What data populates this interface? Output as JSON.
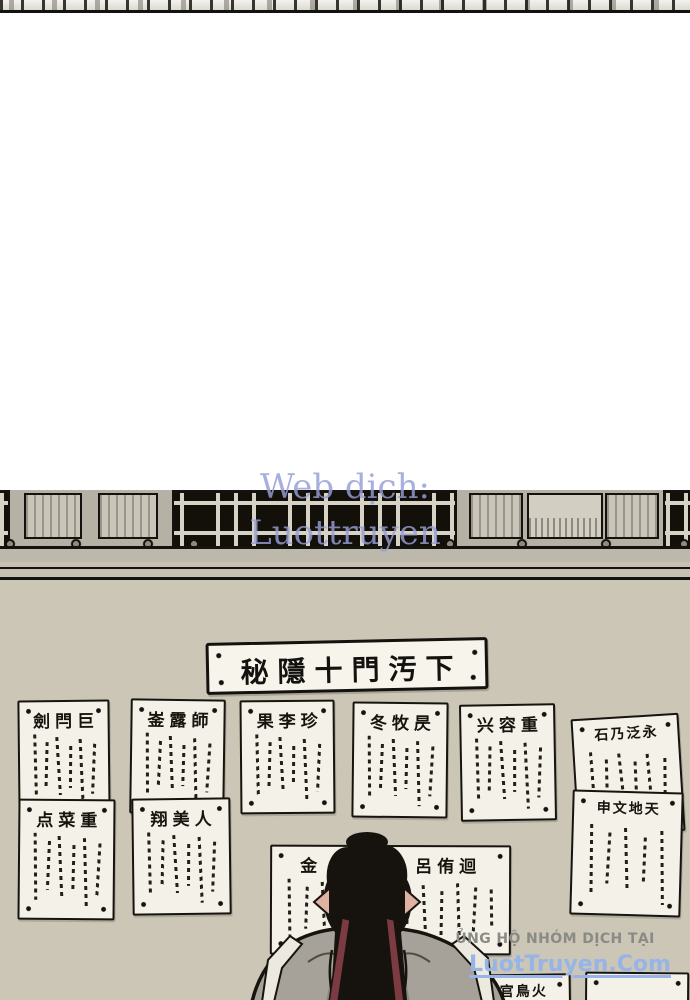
{
  "watermark_center": {
    "line1": "Web dịch:",
    "line2": "Luottruyen"
  },
  "banner": {
    "text": "秘隱十門汚下"
  },
  "papers": [
    {
      "title": "劍閂巨"
    },
    {
      "title": "崟露師"
    },
    {
      "title": "果李珍"
    },
    {
      "title": "冬牧昃"
    },
    {
      "title": "兴容重"
    },
    {
      "title": "石乃泛永"
    },
    {
      "title": "点菜重"
    },
    {
      "title": "翔美人"
    },
    {
      "title": "申文地天"
    },
    {
      "title_left": "金",
      "title_right": "呂侑迴"
    },
    {
      "title": "皇官鳥火"
    },
    {
      "title": ""
    }
  ],
  "watermark_bottom": {
    "support": "ỦNG HỘ NHÓM DỊCH TẠI",
    "site": "LuotTruyen.Com"
  },
  "colors": {
    "wall": "#cbc6b5",
    "paper": "#f4f1e8",
    "ink": "#17140f",
    "lattice_black": "#121009",
    "watermark_lavender": "#969ed6",
    "watermark_blue": "#96b4e8",
    "support_gray": "#8b8b85",
    "ribbon_red": "#7c3a42",
    "robe_gray": "#a6a299"
  }
}
